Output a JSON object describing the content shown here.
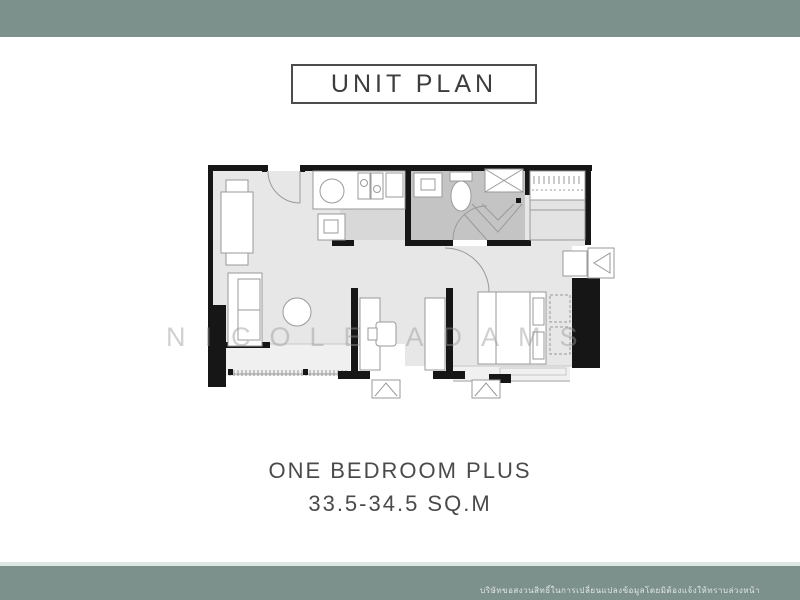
{
  "header": {
    "band_color": "#7d918c"
  },
  "title_box": {
    "label": "UNIT PLAN"
  },
  "plan": {
    "watermark": "NICOLE ADAMS",
    "rooms": [
      "living-dining",
      "kitchen",
      "bathroom",
      "wardrobe",
      "multi-purpose-room",
      "bedroom",
      "balcony"
    ],
    "colors": {
      "wall": "#161616",
      "floor": "#e7e7e7",
      "kitchen_floor": "#d8d8d8",
      "bathroom_floor": "#c4c4c4",
      "balcony_floor": "#f0f0f0",
      "furniture_stroke": "#9a9a9a"
    }
  },
  "caption": {
    "unit_type": "ONE BEDROOM PLUS",
    "area": "33.5-34.5 SQ.M"
  },
  "footer": {
    "band_color": "#7d918c",
    "disclaimer": "บริษัทขอสงวนสิทธิ์ในการเปลี่ยนแปลงข้อมูลโดยมิต้องแจ้งให้ทราบล่วงหน้า"
  }
}
